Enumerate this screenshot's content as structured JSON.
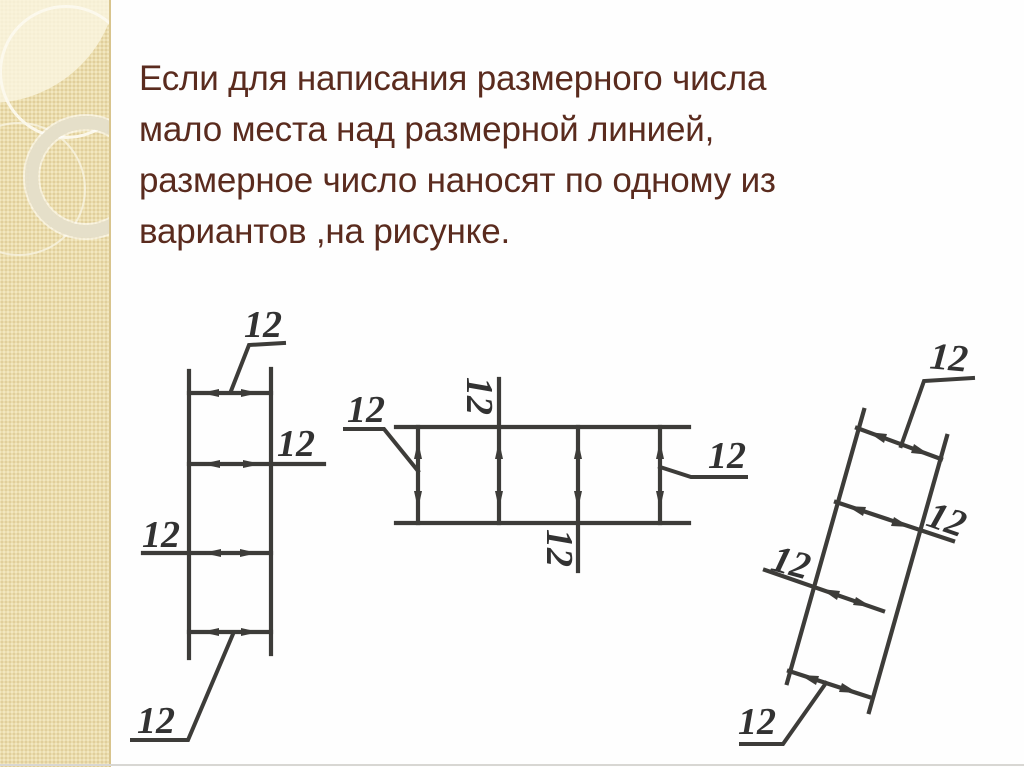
{
  "slide": {
    "background_color": "#fefefe",
    "sidebar_color": "#ebddad",
    "sidebar_edge_color": "#d8c48d",
    "text_color": "#5a2b1e",
    "drawing_stroke_color": "#3d3c39",
    "title_lines": [
      "Если для написания размерного числа",
      "мало места над размерной линией,",
      "размерное число наносят по одному из",
      "вариантов ,на рисунке."
    ]
  },
  "diagrams": {
    "left": {
      "labels": [
        "12",
        "12",
        "12",
        "12"
      ]
    },
    "middle": {
      "labels": [
        "12",
        "12",
        "12",
        "12"
      ]
    },
    "right": {
      "labels": [
        "12",
        "12",
        "12",
        "12"
      ]
    }
  }
}
